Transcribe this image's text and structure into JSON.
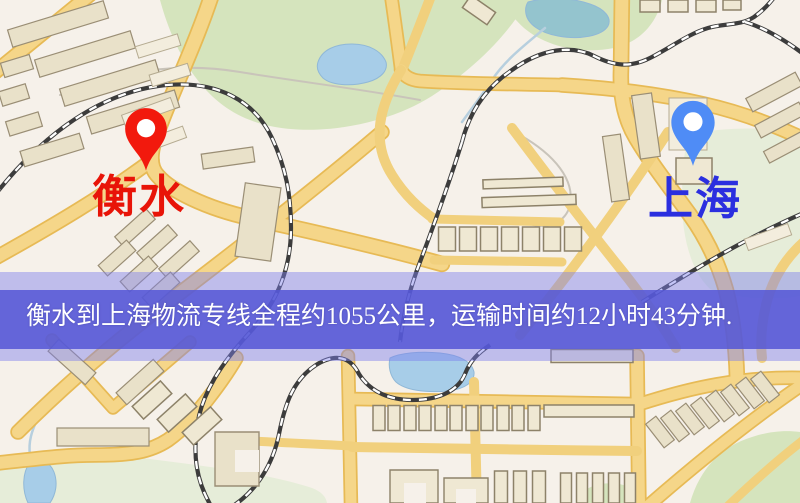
{
  "map": {
    "markers": [
      {
        "id": "hengshui",
        "role": "origin",
        "label": "衡水",
        "pin_color": "#f2190d",
        "label_color": "#e81408",
        "x": 146,
        "y": 178,
        "label_x": 92,
        "label_y": 174
      },
      {
        "id": "shanghai",
        "role": "destination",
        "label": "上海",
        "pin_color": "#4f8cf6",
        "label_color": "#2b2fdf",
        "x": 693,
        "y": 169,
        "label_x": 648,
        "label_y": 176
      }
    ]
  },
  "banner": {
    "text": "衡水到上海物流专线全程约1055公里，运输时间约12小时43分钟.",
    "origin": "衡水",
    "destination": "上海",
    "distance_text": "约1055公里",
    "duration_text": "约12小时43分钟",
    "text_color": "#ffffff"
  },
  "palette": {
    "background": "#f6f1ea",
    "road_fill": "#f6d687",
    "road_edge": "#e8ba52",
    "minor_road": "#f2d07a",
    "building": "#e9e1c8",
    "building_outline": "#9a8e74",
    "building_light": "#f3eddc",
    "green": "#d5e4bc",
    "green_pale": "#e6edd8",
    "water": "#a6cde9",
    "water_teal": "#93c4cf",
    "railway": "#3c3c3c",
    "banner_band": "#5456d6"
  }
}
